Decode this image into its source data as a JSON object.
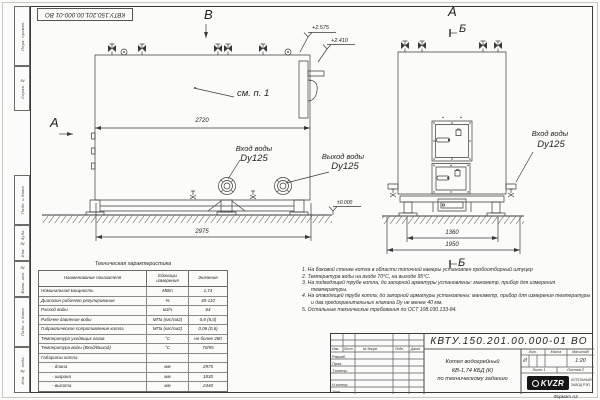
{
  "stamp_top": "КВТУ.150.201.00.000-01 ВО",
  "frame_labels": [
    "Перв. примен.",
    "Справ. №",
    "Подп. и дата",
    "Инв. № дубл.",
    "Взам. инв. №",
    "Подп. и дата",
    "Инв. № подл."
  ],
  "views": {
    "side": {
      "view_marker": "В",
      "left_marker": "А",
      "note_ref": "см. п. 1",
      "dim_inner": "2720",
      "dim_base": "2975",
      "elev_top": "+2.575",
      "elev_flue": "+2.410",
      "elev_zero": "±0.000",
      "inlet_title": "Вход воды",
      "inlet_size": "Dy125",
      "outlet_title": "Выход воды",
      "outlet_size": "Dy125"
    },
    "front": {
      "view_marker": "А",
      "section_marker_top": "Б",
      "section_marker_bottom": "Б",
      "dim_feet": "1360",
      "dim_base": "1950",
      "inlet_title": "Вход воды",
      "inlet_size": "Dy125"
    }
  },
  "tech_table": {
    "title": "Техническая характеристика",
    "col_name": "Наименование показателя",
    "col_unit": "Единицы измерения",
    "col_value": "Значение",
    "rows": [
      [
        "Номинальная мощность",
        "МВт",
        "1,74"
      ],
      [
        "Диапазон рабочего регулирования",
        "%",
        "40-110"
      ],
      [
        "Расход воды",
        "м3/ч",
        "64"
      ],
      [
        "Рабочее давление воды",
        "МПа (кгс/см2)",
        "0,6 (6,0)"
      ],
      [
        "Гидравлическое сопротивление котла",
        "МПа (кгс/см2)",
        "0,06 (0,6)"
      ],
      [
        "Температура уходящих газов",
        "°С",
        "не более 280"
      ],
      [
        "Температура воды (Вход/Выход)",
        "°С",
        "70/95"
      ],
      [
        "Габариты котла",
        "",
        ""
      ],
      [
        "- длина",
        "мм",
        "2975"
      ],
      [
        "- ширина",
        "мм",
        "1830"
      ],
      [
        "- высота",
        "мм",
        "2440"
      ]
    ]
  },
  "notes": [
    "1. На боковой стенке котла в области топочной камеры установлен пробоотборный штуцер",
    "2. Температура воды на входе 70°С, на выходе 95°С.",
    "3. На подводящей трубе котла, до запорной арматуры установлены: манометр, прибор для измерения температуры.",
    "4. На отводящей трубе котла, до запорной арматуры установлены: манометр, прибор для измерения температуры и два предохранительных клапана Dу не менее 40 мм.",
    "5. Остальные технические требования по ОСТ 108.030.133-84."
  ],
  "title_block": {
    "doc_number": "КВТУ.150.201.00.000-01 ВО",
    "col_izm": "Изм.",
    "col_list": "Лист",
    "col_doc": "№ докум.",
    "col_sign": "Подп.",
    "col_date": "Дата",
    "role_1": "Разраб.",
    "role_2": "Пров.",
    "role_3": "Т.контр.",
    "role_4": "Н.контр.",
    "role_5": "Утв.",
    "product_line1": "Котел водогрейный",
    "product_line2": "КВ-1,74 КБД (К)",
    "product_line3": "по техническому заданию",
    "lit_label": "Лит.",
    "mass_label": "Масса",
    "scale_label": "Масштаб",
    "lit_value": "И",
    "scale_value": "1:20",
    "sheet_label": "Лист  1",
    "sheets_label": "Листов  2",
    "logo_text": "KVZR",
    "company_line1": "КОТЕЛЬНЫЙ",
    "company_line2": "ЗАВОД РЭП"
  },
  "format_note": "Формат  А3"
}
